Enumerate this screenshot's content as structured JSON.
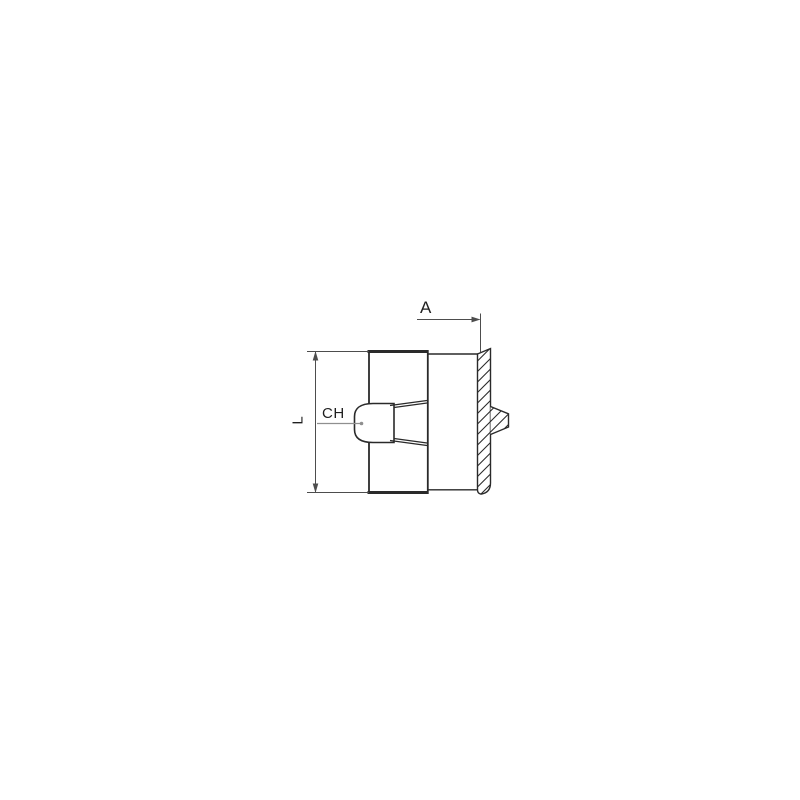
{
  "drawing": {
    "type": "technical-drawing-pipe-fitting-side-view",
    "labels": {
      "thread_dim": "A",
      "hex_label": "CH",
      "length_dim": "L"
    },
    "colors": {
      "background": "#ffffff",
      "outline": "#2a2a2a",
      "dimension": "#4d4d4d",
      "leader": "#8f8f8f"
    }
  }
}
